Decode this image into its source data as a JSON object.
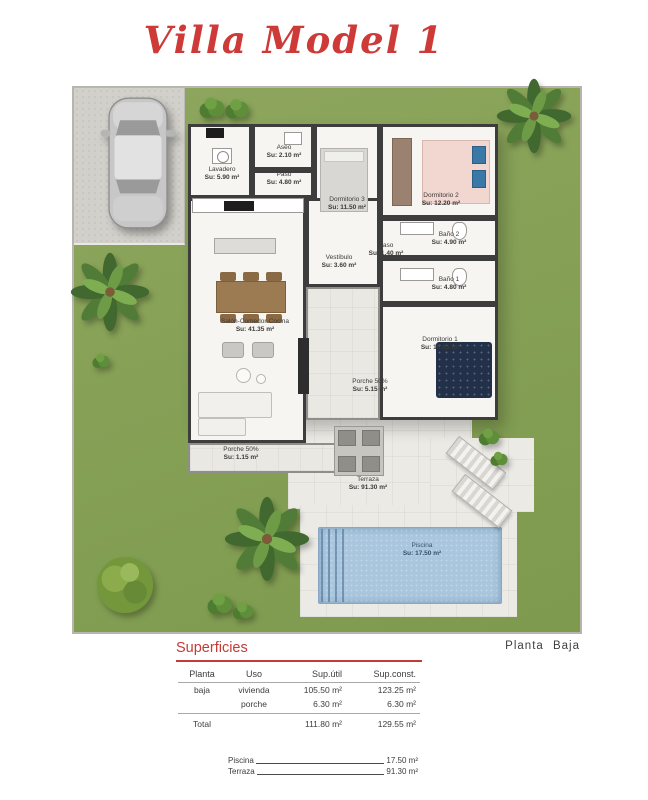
{
  "title": "Villa Model 1",
  "plan_label": "Planta Baja",
  "colors": {
    "accent_red": "#c43a35",
    "grass_green": "#86a156",
    "wall_dark": "#3d3d3d",
    "pool_blue": "#a9c6de"
  },
  "rooms": [
    {
      "name": "Lavadero",
      "area": "Su: 5.90 m²"
    },
    {
      "name": "Aseo",
      "area": "Su: 2.10 m²"
    },
    {
      "name": "Paso",
      "area": "Su: 4.80 m²"
    },
    {
      "name": "Dormitorio 3",
      "area": "Su: 11.50 m²"
    },
    {
      "name": "Dormitorio 2",
      "area": "Su: 12.20 m²"
    },
    {
      "name": "Baño 2",
      "area": "Su: 4.90 m²"
    },
    {
      "name": "Paso",
      "area": "Su: 1.40 m²"
    },
    {
      "name": "Baño 1",
      "area": "Su: 4.80 m²"
    },
    {
      "name": "Vestíbulo",
      "area": "Su: 3.60 m²"
    },
    {
      "name": "Salón-Comedor-Cocina",
      "area": "Su: 41.35 m²"
    },
    {
      "name": "Dormitorio 1",
      "area": "Su: 16.95 m²"
    },
    {
      "name": "Porche 50%",
      "area": "Su: 5.15 m²"
    },
    {
      "name": "Porche 50%",
      "area": "Su: 1.15 m²"
    },
    {
      "name": "Terraza",
      "area": "Su: 91.30 m²"
    },
    {
      "name": "Piscina",
      "area": "Su: 17.50 m²"
    }
  ],
  "superficies": {
    "heading": "Superficies",
    "columns": [
      "Planta",
      "Uso",
      "Sup.útil",
      "Sup.const."
    ],
    "rows": [
      {
        "planta": "baja",
        "uso": "vivienda",
        "util": "105.50 m²",
        "const": "123.25 m²"
      },
      {
        "planta": "",
        "uso": "porche",
        "util": "6.30 m²",
        "const": "6.30 m²"
      }
    ],
    "total": {
      "label": "Total",
      "util": "111.80 m²",
      "const": "129.55 m²"
    }
  },
  "extras": [
    {
      "label": "Piscina",
      "value": "17.50 m²"
    },
    {
      "label": "Terraza",
      "value": "91.30 m²"
    }
  ]
}
